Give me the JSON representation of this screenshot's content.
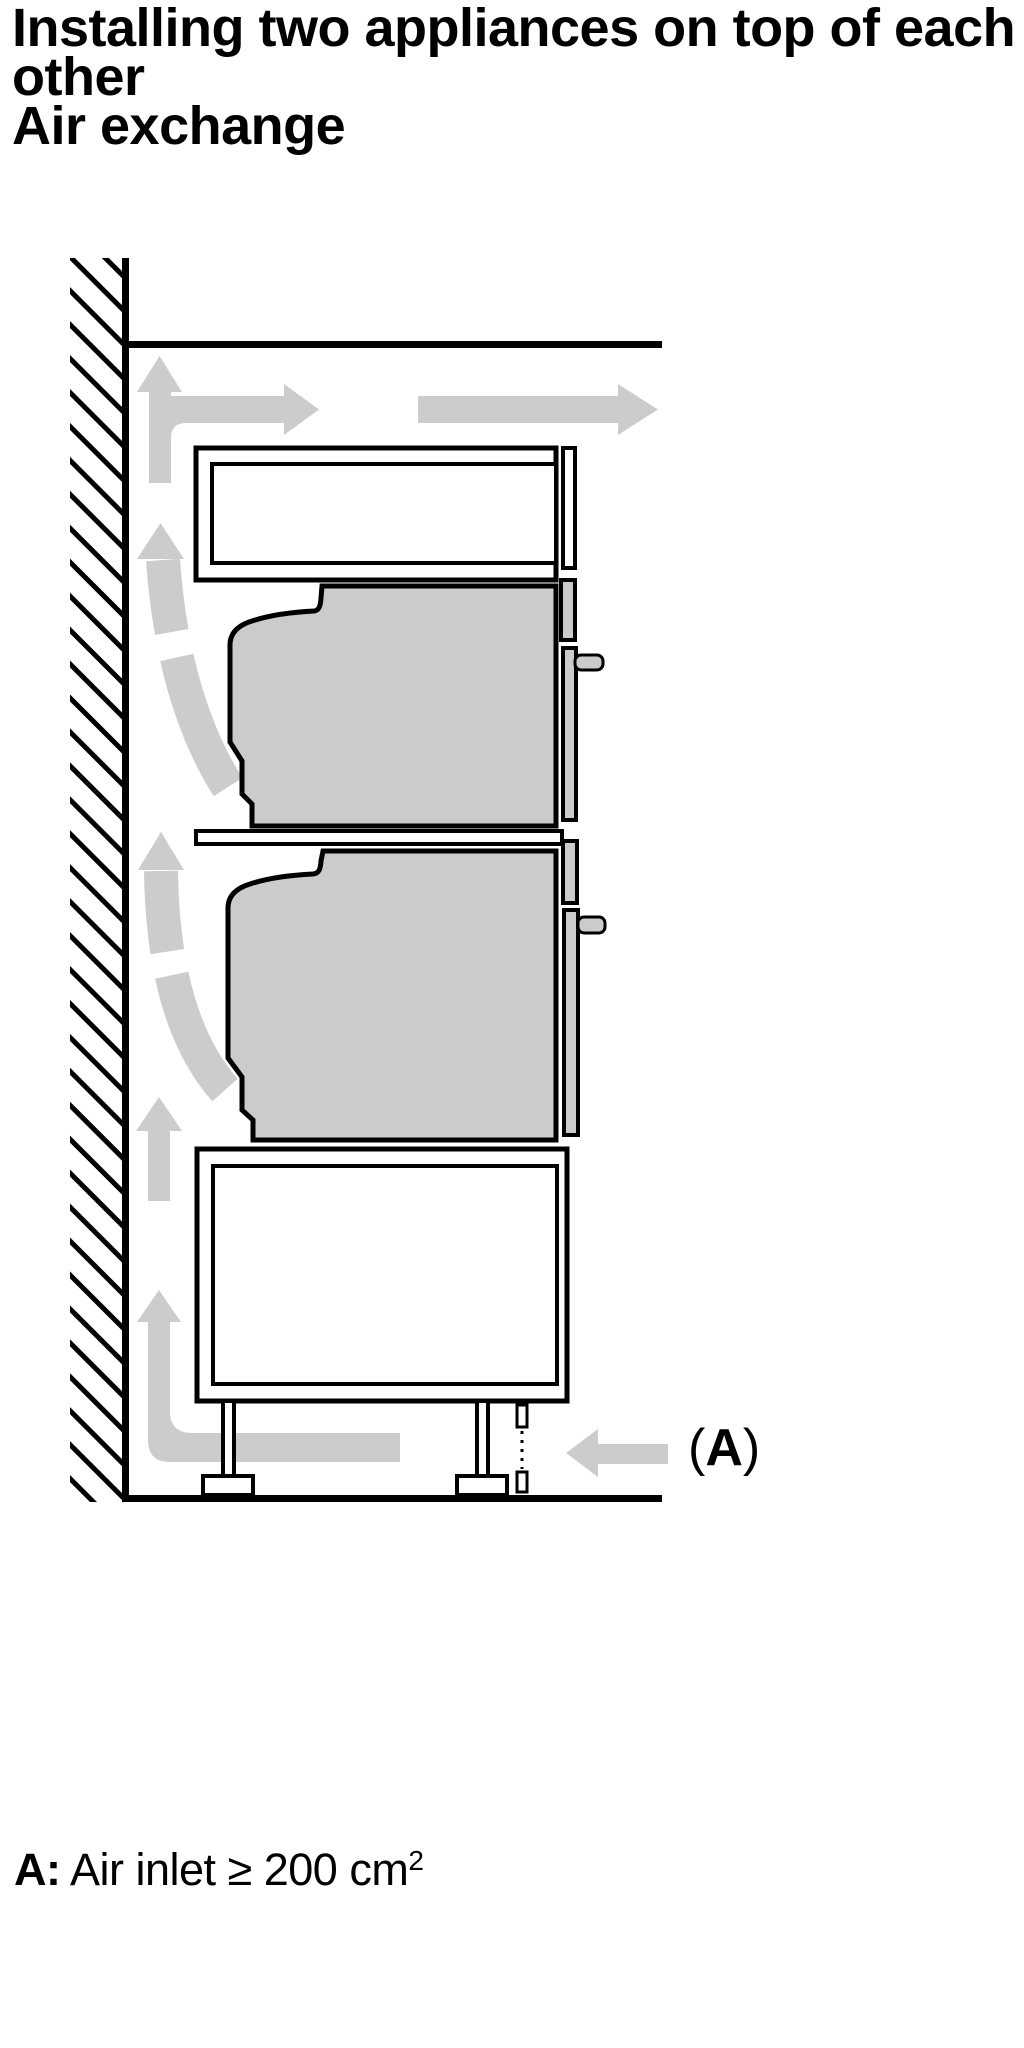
{
  "title": {
    "text": "Installing two appliances on top of each\nother\nAir exchange"
  },
  "figure": {
    "description": "air-exchange-installation-diagram",
    "label": {
      "open": "(",
      "letter": "A",
      "close": ")"
    },
    "colors": {
      "line": "#000000",
      "airflow": "#cccccc",
      "appliance": "#cbcbcb",
      "surface": "#ffffff"
    }
  },
  "caption": {
    "label": "A:",
    "text": " Air inlet ≥ 200 cm",
    "superscript": "2"
  }
}
